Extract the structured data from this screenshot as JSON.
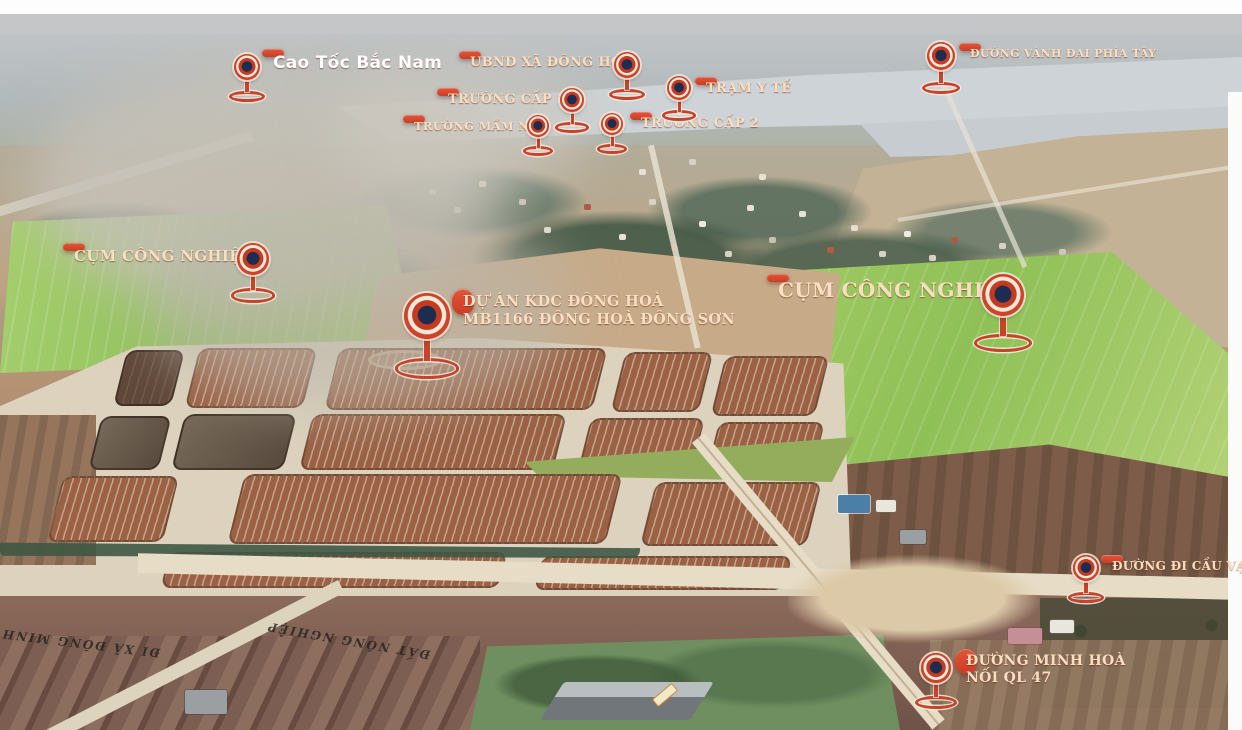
{
  "colors": {
    "accent": "#d9472b",
    "label_text": "#f8dfc2",
    "pin_center": "#1d2d52",
    "pin_ring": "#f2e8da",
    "field_green": "#9cc863",
    "plot_brown": "#9a6144"
  },
  "markers": [
    {
      "id": "cao-toc-bac-nam",
      "lines": [
        "Cao Tốc Bắc Nam"
      ],
      "font": "sans",
      "fs": 17,
      "pin": {
        "x": 247,
        "y": 67,
        "size": 26
      },
      "box": {
        "x": 262,
        "y": 49
      }
    },
    {
      "id": "ubnd-xa-dong-hoa",
      "lines": [
        "UBND XÃ ĐÔNG HOÀ"
      ],
      "font": "serif",
      "fs": 13,
      "pin": {
        "x": 627,
        "y": 65,
        "size": 26
      },
      "box": {
        "x": 459,
        "y": 51
      }
    },
    {
      "id": "truong-cap-1",
      "lines": [
        "TRƯỜNG CẤP 1"
      ],
      "font": "serif",
      "fs": 13,
      "pin": {
        "x": 572,
        "y": 100,
        "size": 24
      },
      "box": {
        "x": 437,
        "y": 88
      }
    },
    {
      "id": "truong-mam-non",
      "lines": [
        "TRƯỜNG MẦM NON"
      ],
      "font": "serif",
      "fs": 11.5,
      "pin": {
        "x": 538,
        "y": 126,
        "size": 22
      },
      "box": {
        "x": 403,
        "y": 115
      }
    },
    {
      "id": "tram-y-te",
      "lines": [
        "TRẠM Y TẾ"
      ],
      "font": "serif",
      "fs": 13,
      "pin": {
        "x": 679,
        "y": 88,
        "size": 24
      },
      "box": {
        "x": 695,
        "y": 77
      }
    },
    {
      "id": "truong-cap-2",
      "lines": [
        "TRƯỜNG CẤP 2"
      ],
      "font": "serif",
      "fs": 13,
      "pin": {
        "x": 612,
        "y": 124,
        "size": 22
      },
      "box": {
        "x": 630,
        "y": 112
      }
    },
    {
      "id": "duong-vanh-dai-phia-tay",
      "lines": [
        "ĐƯỜNG VÀNH ĐAI PHÍA TÂY"
      ],
      "font": "serif",
      "fs": 11,
      "pin": {
        "x": 941,
        "y": 56,
        "size": 28
      },
      "box": {
        "x": 959,
        "y": 43
      }
    },
    {
      "id": "cum-cong-nghiep-left",
      "lines": [
        "CỤM CÔNG NGHIỆP"
      ],
      "font": "serif",
      "fs": 15,
      "pin": {
        "x": 253,
        "y": 259,
        "size": 32
      },
      "box": {
        "x": 63,
        "y": 243
      }
    },
    {
      "id": "du-an-kdc-dong-hoa",
      "lines": [
        "DỰ ÁN KDC ĐÔNG HOÀ",
        "MB1166 ĐÔNG HOÀ ĐÔNG SƠN"
      ],
      "font": "serif",
      "fs": 14.5,
      "pin": {
        "x": 427,
        "y": 316,
        "size": 46
      },
      "box": {
        "x": 452,
        "y": 289
      }
    },
    {
      "id": "cum-cong-nghiep-right",
      "lines": [
        "CỤM CÔNG NGHIỆP"
      ],
      "font": "serif",
      "fs": 20,
      "pin": {
        "x": 1003,
        "y": 295,
        "size": 42
      },
      "box": {
        "x": 767,
        "y": 274
      }
    },
    {
      "id": "duong-di-cau-van",
      "lines": [
        "ĐƯỜNG ĐI CẦU VẠN"
      ],
      "font": "serif",
      "fs": 12,
      "pin": {
        "x": 1086,
        "y": 568,
        "size": 26
      },
      "box": {
        "x": 1101,
        "y": 555
      }
    },
    {
      "id": "duong-minh-hoa-noi-ql-47",
      "lines": [
        "ĐƯỜNG MINH HOÀ",
        "NỐI QL 47"
      ],
      "font": "serif",
      "fs": 14,
      "pin": {
        "x": 936,
        "y": 668,
        "size": 30
      },
      "box": {
        "x": 955,
        "y": 649
      }
    }
  ],
  "ground_labels": [
    {
      "id": "di-xa-dong-minh",
      "text": "ĐI XÃ ĐÔNG MINH",
      "x": 160,
      "y": 646,
      "rot": 187,
      "fs": 12
    },
    {
      "id": "dat-nong-nghiep",
      "text": "ĐẤT NÔNG NGHIỆP",
      "x": 430,
      "y": 648,
      "rot": 190,
      "fs": 12
    }
  ]
}
